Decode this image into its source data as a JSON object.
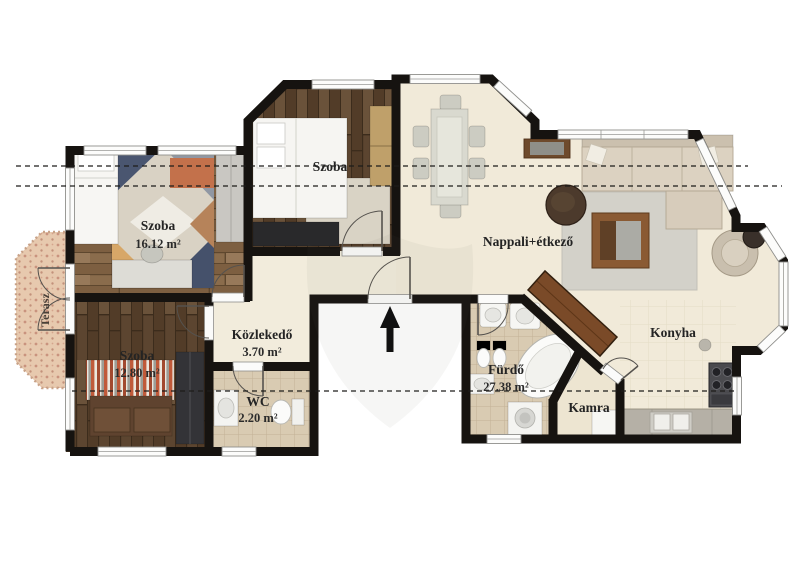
{
  "plan": {
    "type": "apartment-floor-plan",
    "rooms": {
      "bedroom_top_left": {
        "label": "Szoba",
        "area": "16.12 m²"
      },
      "bedroom_top_middle": {
        "label": "Szoba"
      },
      "bedroom_bottom_left": {
        "label": "Szoba",
        "area": "12.80 m²"
      },
      "hallway": {
        "label": "Közlekedő",
        "area": "3.70 m²"
      },
      "wc": {
        "label": "WC",
        "area": "2.20 m²"
      },
      "bathroom": {
        "label": "Fürdő",
        "area": "27.38 m²"
      },
      "pantry": {
        "label": "Kamra"
      },
      "living_dining": {
        "label": "Nappali+étkező"
      },
      "kitchen": {
        "label": "Konyha"
      },
      "terrace": {
        "label": "Terasz"
      }
    },
    "icons": {
      "entrance_arrow": "entrance-arrow"
    },
    "colors": {
      "wall": "#161310",
      "floor_wood_medium": "#8a6c4c",
      "floor_wood_dark": "#5c4530",
      "floor_cream": "#f2ecdc",
      "floor_tile": "#d9cbb2",
      "pantry_floor": "#ede5d1",
      "terrace": "#e7c9ae",
      "background": "#ffffff"
    }
  }
}
